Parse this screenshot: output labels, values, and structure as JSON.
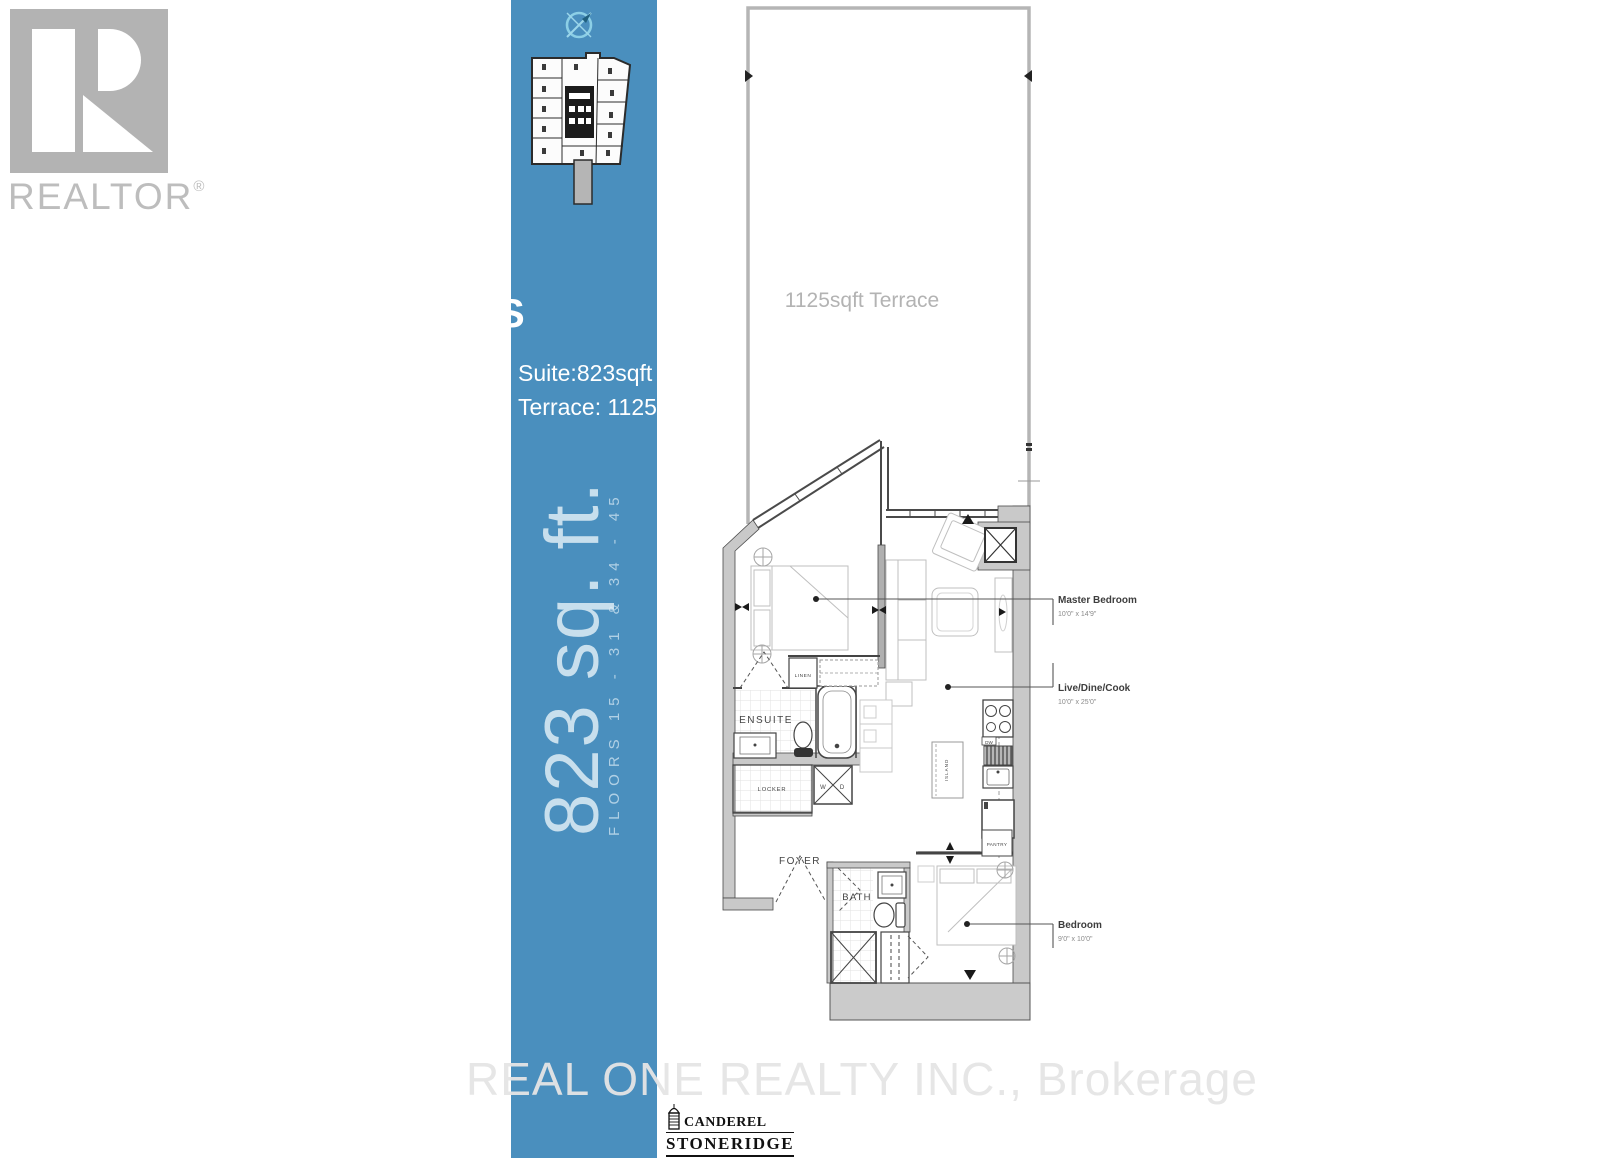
{
  "colors": {
    "band_blue": "#4a8fbe",
    "wall_gray": "#c9c9c9",
    "plan_line": "#4a4a4a",
    "terrace_border": "#b5b5b5",
    "label_dark": "#3d3d3d",
    "label_muted": "#8a8a8a",
    "watermark_gray": "#e5e5e5",
    "logo_gray": "#b3b3b3"
  },
  "branding": {
    "realtor_logo_text": "REALTOR",
    "registered_mark": "®"
  },
  "sidebar": {
    "suite_area": "Suite:823sqft",
    "terrace_area": "Terrace: 1125sqft",
    "big_area": "823  sq.  ft.",
    "floors": "FLOORS 15 - 31 & 34 - 45",
    "stray_letter": "S"
  },
  "floorplan": {
    "terrace_label": "1125sqft Terrace",
    "rooms": [
      {
        "name": "Master Bedroom",
        "dims": "10'0\" x 14'9\""
      },
      {
        "name": "Live/Dine/Cook",
        "dims": "10'0\" x 25'0\""
      },
      {
        "name": "Bedroom",
        "dims": "9'0\" x 10'0\""
      }
    ],
    "small_labels": {
      "ensuite": "ENSUITE",
      "linen": "LINEN",
      "locker": "LOCKER",
      "foyer": "FOYER",
      "bath": "BATH",
      "pantry": "PANTRY",
      "island": "ISLAND",
      "dw": "DW",
      "washer": "W",
      "dryer": "D"
    }
  },
  "footer": {
    "watermark": "REAL ONE REALTY INC., Brokerage",
    "developer_line1": "CANDEREL",
    "developer_line2": "STONERIDGE"
  }
}
